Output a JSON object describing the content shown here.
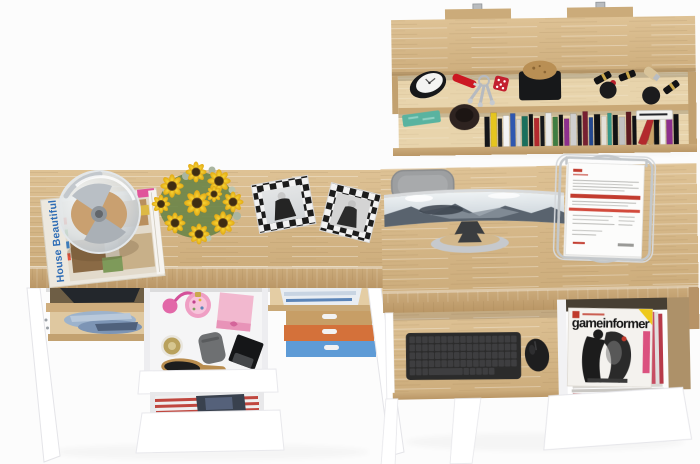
{
  "meta": {
    "type": "3d-product-render",
    "subject": "Top-down view of a two-desk home office furniture set with wall shelf, open drawers and accessories"
  },
  "palette": {
    "background": "#fcfcfc",
    "wood_top": "#d8bc8e",
    "wood_edge": "#c2a170",
    "wood_interior": "#e8d4ac",
    "furniture_white": "#ffffff",
    "chair_gray": "#9d9fa1",
    "keyboard_black": "#2b2b2b",
    "box_tan": "#c79e66",
    "box_orange": "#d4713a",
    "box_blue": "#5e9bd6",
    "pink_box": "#f2b8cf",
    "sunflower_yellow": "#f2c21e",
    "document_red": "#c23b2e",
    "denim_blue": "#7d95b5"
  },
  "texts": {
    "magazine_title": "House Beautiful",
    "gaming_magazine_title": "gameinformer"
  },
  "shelf": {
    "books": [
      {
        "w": 5,
        "h": 30,
        "c": "#15161a"
      },
      {
        "w": 6,
        "h": 34,
        "c": "#e5c51f"
      },
      {
        "w": 4,
        "h": 28,
        "c": "#23252a"
      },
      {
        "w": 6,
        "h": 31,
        "c": "#f4f4f4"
      },
      {
        "w": 5,
        "h": 33,
        "c": "#2e57b0"
      },
      {
        "w": 4,
        "h": 27,
        "c": "#d8d8d8"
      },
      {
        "w": 6,
        "h": 30,
        "c": "#1a6f5c"
      },
      {
        "w": 4,
        "h": 32,
        "c": "#101114"
      },
      {
        "w": 5,
        "h": 28,
        "c": "#b3292d"
      },
      {
        "w": 4,
        "h": 30,
        "c": "#16181c"
      },
      {
        "w": 6,
        "h": 33,
        "c": "#e9e9e9"
      },
      {
        "w": 5,
        "h": 29,
        "c": "#3f7d42"
      },
      {
        "w": 4,
        "h": 31,
        "c": "#101114"
      },
      {
        "w": 5,
        "h": 27,
        "c": "#8d2f8d"
      },
      {
        "w": 6,
        "h": 32,
        "c": "#cfcfcf"
      },
      {
        "w": 4,
        "h": 30,
        "c": "#1b1d22"
      },
      {
        "w": 5,
        "h": 34,
        "c": "#772031"
      },
      {
        "w": 4,
        "h": 28,
        "c": "#23478f"
      },
      {
        "w": 6,
        "h": 31,
        "c": "#101114"
      },
      {
        "w": 5,
        "h": 29,
        "c": "#e3e0d8"
      },
      {
        "w": 4,
        "h": 32,
        "c": "#35998a"
      },
      {
        "w": 5,
        "h": 30,
        "c": "#101114"
      },
      {
        "w": 6,
        "h": 28,
        "c": "#c2c2c2"
      },
      {
        "w": 5,
        "h": 33,
        "c": "#5d1a20"
      },
      {
        "w": 4,
        "h": 29,
        "c": "#101114"
      },
      {
        "w": 8,
        "h": 34,
        "c": "#b3292d",
        "lean": 22
      },
      {
        "w": 6,
        "h": 30,
        "c": "#caa369",
        "lean": 16
      },
      {
        "w": 5,
        "h": 31,
        "c": "#101114"
      },
      {
        "w": 5,
        "h": 28,
        "c": "#f2f2f2"
      },
      {
        "w": 6,
        "h": 33,
        "c": "#8d2f8d"
      },
      {
        "w": 5,
        "h": 30,
        "c": "#101114"
      }
    ]
  },
  "objects": [
    "wall-shelf",
    "wall-bracket",
    "alarm-clock",
    "pocket-knife",
    "key-set",
    "dice-keychain",
    "valet-tray",
    "lipstick",
    "makeup-brush",
    "notepad",
    "wooden-bowl",
    "books-row",
    "left-desk",
    "magazine-house-beautiful",
    "dome-lamp",
    "sunflower-bouquet",
    "photo-frame-left",
    "photo-frame-right",
    "dark-clothes",
    "denim-clothes",
    "makeup-drawer",
    "perfume-atomizer",
    "pink-gift-box",
    "cream-jar",
    "gray-pouch",
    "black-box",
    "hair-brush",
    "striped-fabric-drawer",
    "folded-cloth",
    "storage-box-tan",
    "storage-box-orange",
    "storage-box-blue",
    "right-desk",
    "office-chair",
    "curved-monitor",
    "monitor-stand",
    "document-tray",
    "keyboard-tray",
    "keyboard",
    "mouse",
    "magazine-drawer",
    "gameinformer-magazine",
    "drawer-front"
  ]
}
